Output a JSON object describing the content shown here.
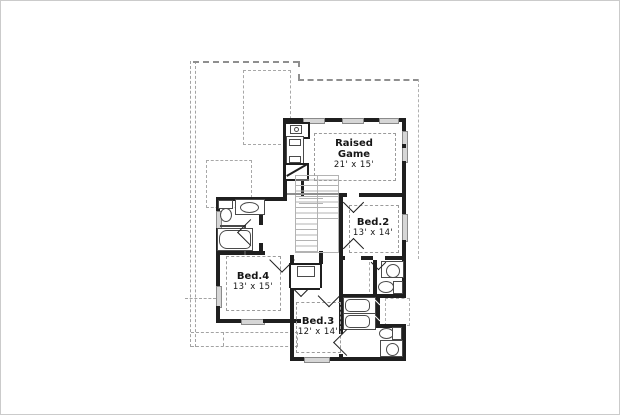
{
  "document": {
    "type": "floor-plan",
    "floor": "upper"
  },
  "rooms": [
    {
      "id": "raised-game",
      "name_lines": [
        "Raised",
        "Game"
      ],
      "dims": "21' x 15'"
    },
    {
      "id": "bed2",
      "name": "Bed.2",
      "dims": "13' x 14'"
    },
    {
      "id": "bed4",
      "name": "Bed.4",
      "dims": "13' x 15'"
    },
    {
      "id": "bed3",
      "name": "Bed.3",
      "dims": "12' x 14'"
    }
  ],
  "fixtures": [
    "toilet",
    "sink",
    "bathtub",
    "stairs",
    "closet",
    "door-swing",
    "window",
    "chase"
  ],
  "colors": {
    "wall": "#1f1f1f",
    "roof_dash": "#a3a3a3",
    "label_dash": "#9b9b9b",
    "stair_line": "#b3b3b3",
    "fixture_line": "#4a4a4a",
    "background": "#ffffff"
  }
}
